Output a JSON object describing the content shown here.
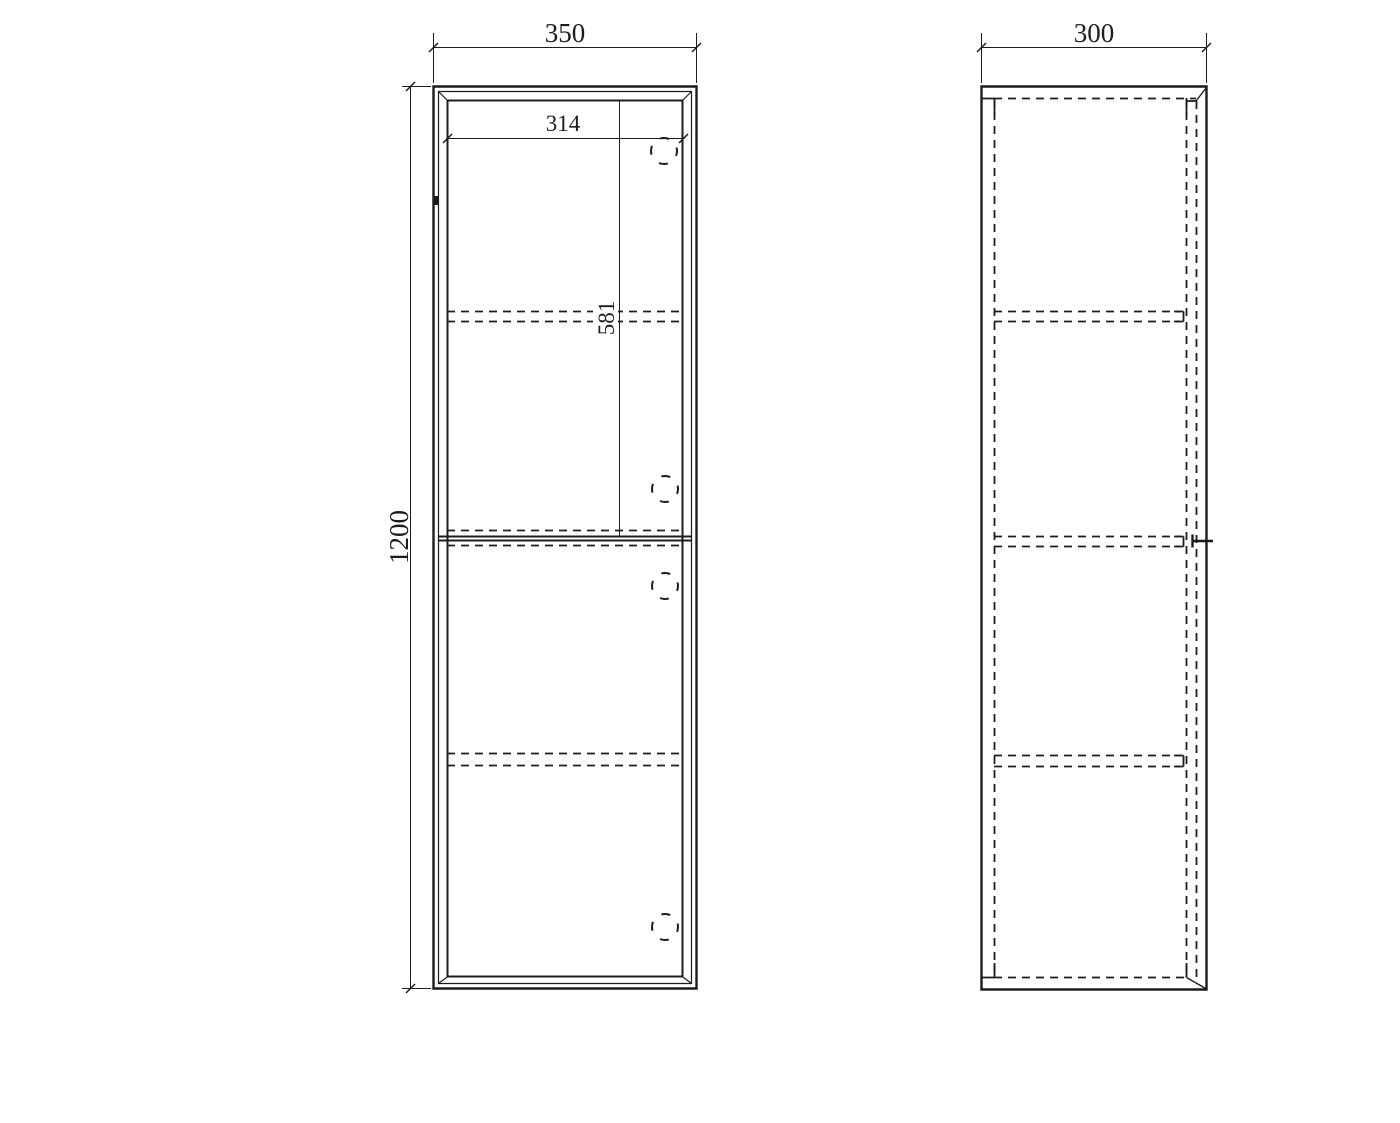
{
  "meta": {
    "drawing_type": "cabinet technical drawing, front and side orthographic views",
    "line_color": "#1c1c1c",
    "background_color": "#ffffff"
  },
  "front_view": {
    "dim_width": "350",
    "dim_height": "1200",
    "dim_inner_width": "314",
    "dim_upper_door_height": "581",
    "door_count": 2,
    "hinge_hole_count": 4,
    "hidden_shelf_line_rows": 3
  },
  "side_view": {
    "dim_depth": "300",
    "hidden_shelf_line_rows": 3
  }
}
